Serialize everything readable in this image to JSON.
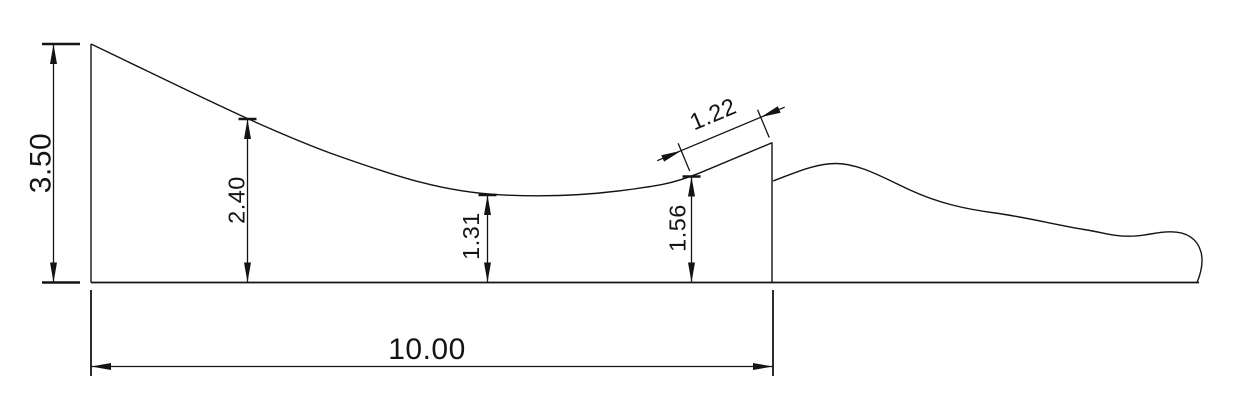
{
  "drawing": {
    "colors": {
      "background": "#ffffff",
      "line": "#141414"
    },
    "dimensions": {
      "overall_height": {
        "label": "3.50"
      },
      "inrun_height": {
        "label": "2.40"
      },
      "valley_height": {
        "label": "1.31"
      },
      "takeoff_base_height": {
        "label": "1.56"
      },
      "takeoff_ramp_length": {
        "label": "1.22"
      },
      "overall_length": {
        "label": "10.00"
      }
    }
  }
}
